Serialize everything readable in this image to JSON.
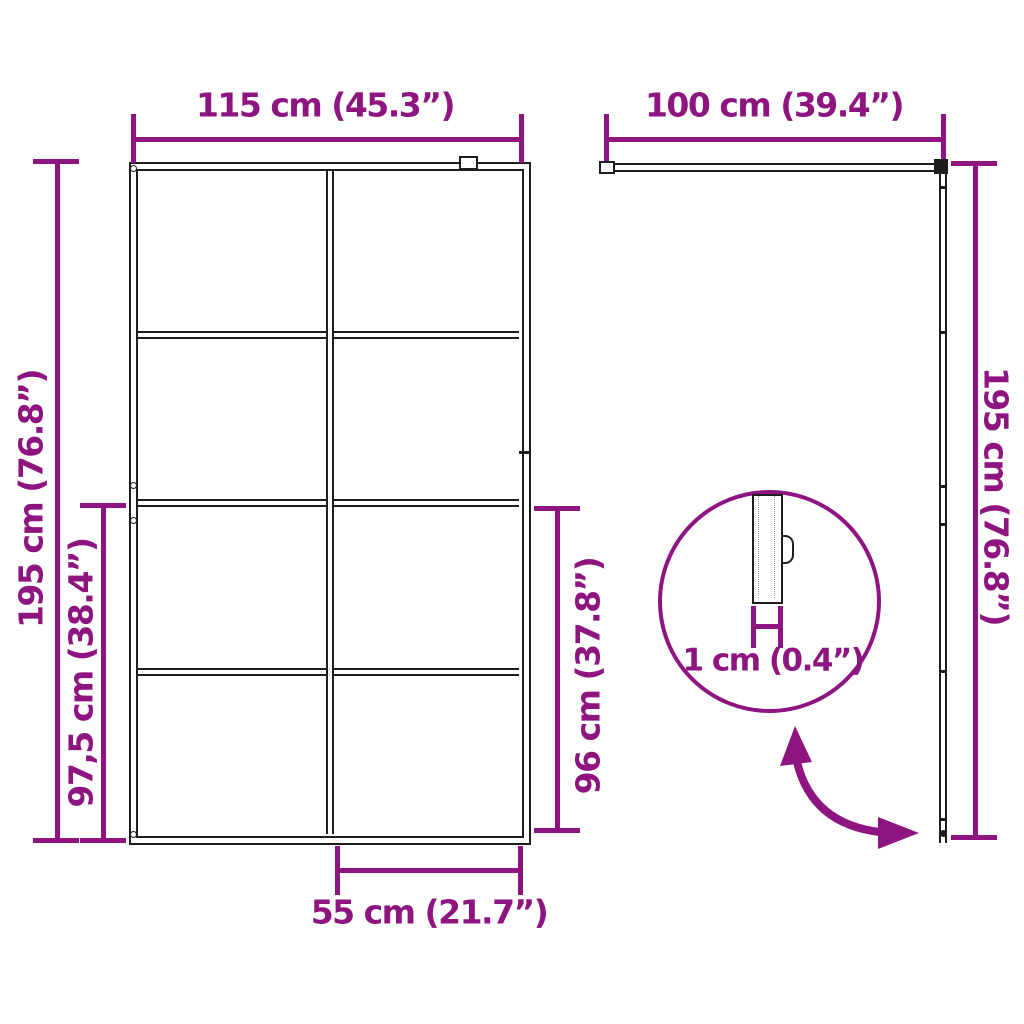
{
  "diagram": {
    "accent_color": "#8E1580",
    "line_color": "#1e1e1e",
    "front_view": {
      "top_width": "115 cm (45.3”)",
      "total_height": "195 cm (76.8”)",
      "lower_section_height": "97,5 cm (38.4”)",
      "glass_lower_height": "96 cm (37.8”)",
      "bottom_width": "55 cm (21.7”)"
    },
    "side_view": {
      "top_width": "100 cm (39.4”)",
      "total_height": "195 cm (76.8”)"
    },
    "detail": {
      "thickness": "1 cm (0.4”)"
    }
  }
}
